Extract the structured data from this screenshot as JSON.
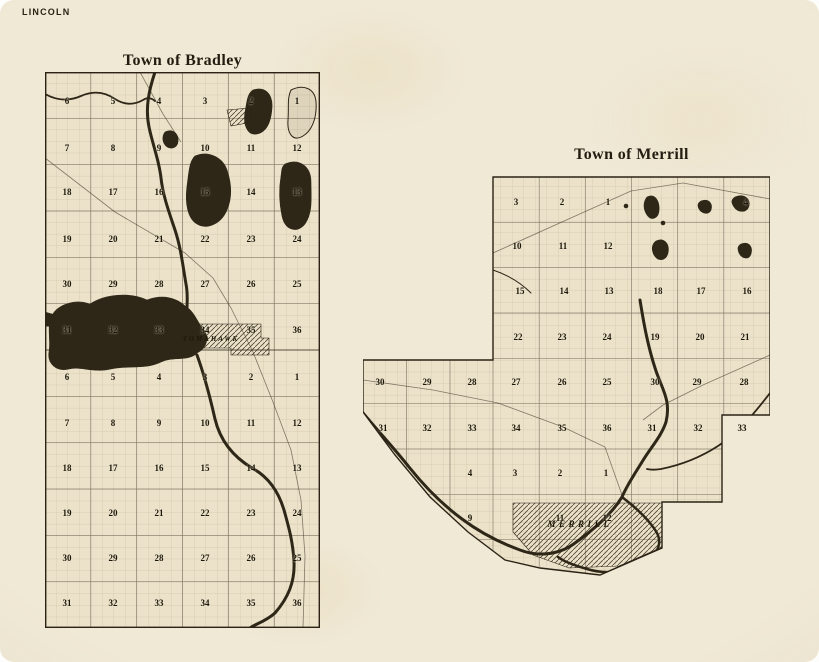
{
  "page": {
    "county_label": "LINCOLN"
  },
  "colors": {
    "paper": "#f0e9d6",
    "map_paper": "#ebe2c9",
    "ink": "#2b2215",
    "water": "#2e2617"
  },
  "bradley": {
    "title": "Town of Bradley",
    "city_label": "TOMAHAWK",
    "cols_x": [
      22,
      68,
      114,
      160,
      206,
      252
    ],
    "rows": [
      {
        "y": 29,
        "nums": [
          "6",
          "5",
          "4",
          "3",
          "2",
          "1"
        ]
      },
      {
        "y": 76,
        "nums": [
          "7",
          "8",
          "9",
          "10",
          "11",
          "12"
        ]
      },
      {
        "y": 120,
        "nums": [
          "18",
          "17",
          "16",
          "15",
          "14",
          "13"
        ]
      },
      {
        "y": 167,
        "nums": [
          "19",
          "20",
          "21",
          "22",
          "23",
          "24"
        ]
      },
      {
        "y": 212,
        "nums": [
          "30",
          "29",
          "28",
          "27",
          "26",
          "25"
        ]
      },
      {
        "y": 258,
        "nums": [
          "31",
          "32",
          "33",
          "34",
          "35",
          "36"
        ]
      },
      {
        "y": 305,
        "nums": [
          "6",
          "5",
          "4",
          "3",
          "2",
          "1"
        ]
      },
      {
        "y": 351,
        "nums": [
          "7",
          "8",
          "9",
          "10",
          "11",
          "12"
        ]
      },
      {
        "y": 396,
        "nums": [
          "18",
          "17",
          "16",
          "15",
          "14",
          "13"
        ]
      },
      {
        "y": 441,
        "nums": [
          "19",
          "20",
          "21",
          "22",
          "23",
          "24"
        ]
      },
      {
        "y": 486,
        "nums": [
          "30",
          "29",
          "28",
          "27",
          "26",
          "25"
        ]
      },
      {
        "y": 531,
        "nums": [
          "31",
          "32",
          "33",
          "34",
          "35",
          "36"
        ]
      }
    ]
  },
  "merrill": {
    "title": "Town of Merrill",
    "city_label": "MERRILL",
    "sections": [
      {
        "n": "3",
        "x": 153,
        "y": 27
      },
      {
        "n": "2",
        "x": 199,
        "y": 27
      },
      {
        "n": "1",
        "x": 245,
        "y": 27
      },
      {
        "n": "4",
        "x": 383,
        "y": 27
      },
      {
        "n": "10",
        "x": 154,
        "y": 71
      },
      {
        "n": "11",
        "x": 200,
        "y": 71
      },
      {
        "n": "12",
        "x": 245,
        "y": 71
      },
      {
        "n": "15",
        "x": 157,
        "y": 116
      },
      {
        "n": "14",
        "x": 201,
        "y": 116
      },
      {
        "n": "13",
        "x": 246,
        "y": 116
      },
      {
        "n": "18",
        "x": 295,
        "y": 116
      },
      {
        "n": "17",
        "x": 338,
        "y": 116
      },
      {
        "n": "16",
        "x": 384,
        "y": 116
      },
      {
        "n": "22",
        "x": 155,
        "y": 162
      },
      {
        "n": "23",
        "x": 199,
        "y": 162
      },
      {
        "n": "24",
        "x": 244,
        "y": 162
      },
      {
        "n": "19",
        "x": 292,
        "y": 162
      },
      {
        "n": "20",
        "x": 337,
        "y": 162
      },
      {
        "n": "21",
        "x": 382,
        "y": 162
      },
      {
        "n": "30",
        "x": 17,
        "y": 207
      },
      {
        "n": "29",
        "x": 64,
        "y": 207
      },
      {
        "n": "28",
        "x": 109,
        "y": 207
      },
      {
        "n": "27",
        "x": 153,
        "y": 207
      },
      {
        "n": "26",
        "x": 199,
        "y": 207
      },
      {
        "n": "25",
        "x": 244,
        "y": 207
      },
      {
        "n": "30",
        "x": 292,
        "y": 207
      },
      {
        "n": "29",
        "x": 334,
        "y": 207
      },
      {
        "n": "28",
        "x": 381,
        "y": 207
      },
      {
        "n": "31",
        "x": 20,
        "y": 253
      },
      {
        "n": "32",
        "x": 64,
        "y": 253
      },
      {
        "n": "33",
        "x": 109,
        "y": 253
      },
      {
        "n": "34",
        "x": 153,
        "y": 253
      },
      {
        "n": "35",
        "x": 199,
        "y": 253
      },
      {
        "n": "36",
        "x": 244,
        "y": 253
      },
      {
        "n": "31",
        "x": 289,
        "y": 253
      },
      {
        "n": "32",
        "x": 335,
        "y": 253
      },
      {
        "n": "33",
        "x": 379,
        "y": 253
      },
      {
        "n": "4",
        "x": 107,
        "y": 298
      },
      {
        "n": "3",
        "x": 152,
        "y": 298
      },
      {
        "n": "2",
        "x": 197,
        "y": 298
      },
      {
        "n": "1",
        "x": 243,
        "y": 298
      },
      {
        "n": "9",
        "x": 107,
        "y": 343
      },
      {
        "n": "11",
        "x": 197,
        "y": 343
      },
      {
        "n": "12",
        "x": 244,
        "y": 343
      }
    ]
  }
}
